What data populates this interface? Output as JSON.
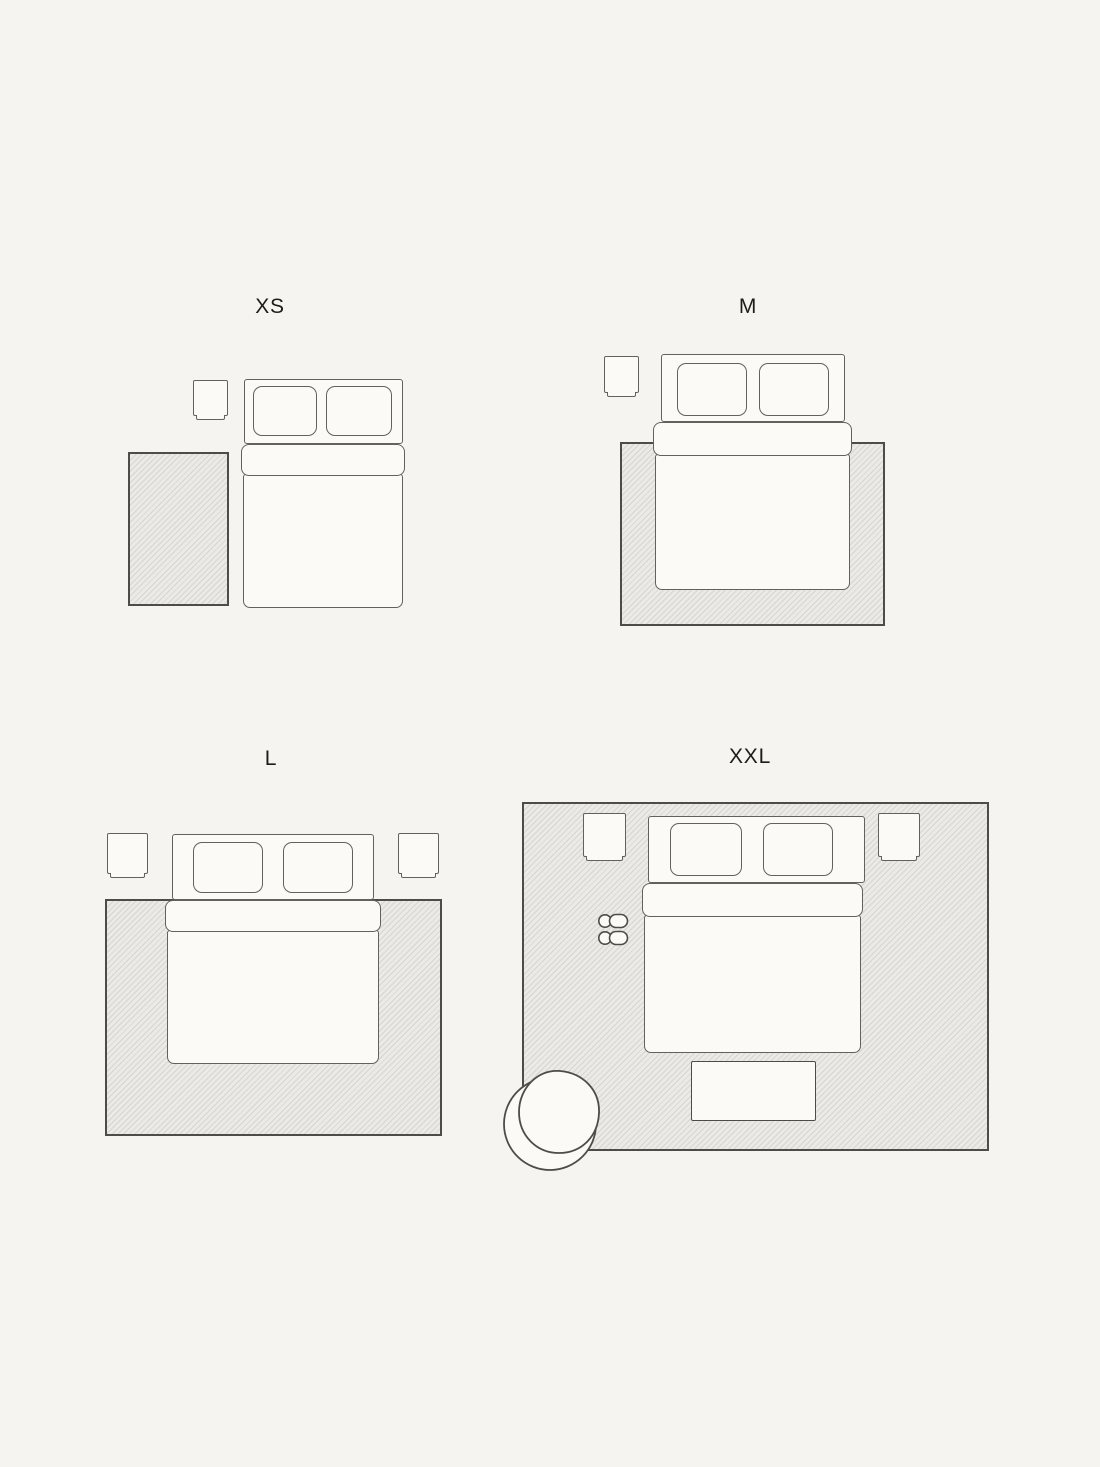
{
  "colors": {
    "background": "#f6f4f0",
    "fill": "#fbfaf7",
    "stroke": "#63615b",
    "stroke_dark": "#4e4c47",
    "rug_base": "#eceae7",
    "rug_line": "#d6d5d1",
    "label": "#1d1c1a"
  },
  "panels": [
    {
      "id": "xs",
      "label": "XS",
      "objects": [
        "rug",
        "nightstand",
        "double-bed"
      ]
    },
    {
      "id": "m",
      "label": "M",
      "objects": [
        "rug",
        "nightstand",
        "double-bed"
      ]
    },
    {
      "id": "l",
      "label": "L",
      "objects": [
        "rug",
        "nightstand-left",
        "nightstand-right",
        "double-bed"
      ]
    },
    {
      "id": "xxl",
      "label": "XXL",
      "objects": [
        "rug",
        "nightstand-left",
        "nightstand-right",
        "double-bed",
        "slippers",
        "bench",
        "armchair"
      ]
    }
  ]
}
